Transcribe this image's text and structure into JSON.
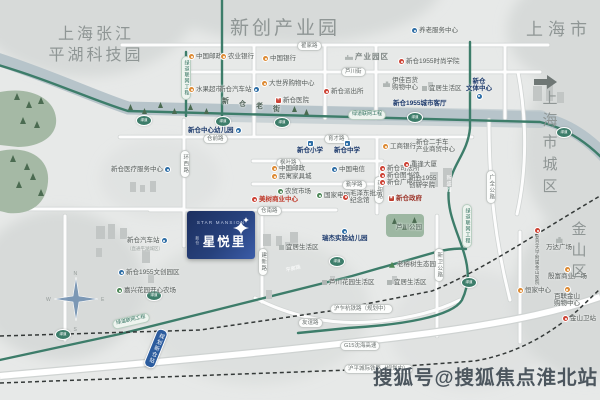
{
  "watermark": "搜狐号@搜狐焦点淮北站",
  "project": {
    "name_en": "STAR MANSION",
    "name_cn": "星悦里",
    "district": "新仓"
  },
  "area_labels": [
    {
      "id": "al0",
      "text": "上海张江\n平湖科技园"
    },
    {
      "id": "al1",
      "text": "新创产业园"
    },
    {
      "id": "al2",
      "text": "上海市"
    },
    {
      "id": "al3",
      "text": "上海市城区"
    },
    {
      "id": "al4",
      "text": "金山区"
    }
  ],
  "old_street": {
    "text": "新仓老街",
    "x": 222,
    "y": 98
  },
  "badge_text": "绿道",
  "station": {
    "t": "规划新仓站",
    "x": 150,
    "y": 328
  },
  "road_labels": [
    {
      "t": "翟家路",
      "x": 297,
      "y": 41
    },
    {
      "t": "芦川街",
      "x": 341,
      "y": 67
    },
    {
      "t": "仓前路",
      "x": 203,
      "y": 134
    },
    {
      "t": "育才路",
      "x": 324,
      "y": 134
    },
    {
      "t": "枫叶路",
      "x": 276,
      "y": 158
    },
    {
      "t": "勤学路",
      "x": 342,
      "y": 180
    },
    {
      "t": "仓南路",
      "x": 257,
      "y": 206
    },
    {
      "t": "友谊路",
      "x": 298,
      "y": 318
    },
    {
      "t": "沪乍杭铁路（规划中）",
      "x": 330,
      "y": 304
    },
    {
      "t": "G15沈海高速",
      "x": 340,
      "y": 341
    },
    {
      "t": "沪平城际铁路（规划中）",
      "x": 344,
      "y": 364
    },
    {
      "t": "环西路",
      "x": 180,
      "y": 150,
      "vertical": true
    },
    {
      "t": "新阳路",
      "x": 374,
      "y": 176,
      "vertical": true
    },
    {
      "t": "建新路",
      "x": 258,
      "y": 248,
      "vertical": true
    },
    {
      "t": "新卫公路",
      "x": 434,
      "y": 248,
      "vertical": true
    },
    {
      "t": "广全公路",
      "x": 486,
      "y": 170,
      "vertical": true
    },
    {
      "t": "新盛路",
      "x": 444,
      "y": 172,
      "vertical": true,
      "style": "onGreen"
    },
    {
      "t": "平廊路",
      "x": 283,
      "y": 266,
      "rotate": -14,
      "style": "onGreen2"
    },
    {
      "t": "绿道联网工程",
      "x": 348,
      "y": 110,
      "style": "green"
    },
    {
      "t": "绿道联网工程",
      "x": 181,
      "y": 56,
      "vertical": true,
      "style": "green"
    },
    {
      "t": "绿道联网工程",
      "x": 462,
      "y": 204,
      "vertical": true,
      "style": "green"
    },
    {
      "t": "绿道联网工程",
      "x": 112,
      "y": 316,
      "rotate": -13,
      "style": "green"
    }
  ],
  "badges": [
    {
      "x": 136,
      "y": 115
    },
    {
      "x": 215,
      "y": 116
    },
    {
      "x": 274,
      "y": 117
    },
    {
      "x": 407,
      "y": 112
    },
    {
      "x": 556,
      "y": 127
    },
    {
      "x": 55,
      "y": 329
    },
    {
      "x": 146,
      "y": 290
    },
    {
      "x": 329,
      "y": 256
    },
    {
      "x": 461,
      "y": 277
    }
  ],
  "pois": [
    {
      "t": "中国邮政",
      "type": "post",
      "x": 189,
      "y": 53
    },
    {
      "t": "农业银行",
      "type": "bank",
      "x": 221,
      "y": 53
    },
    {
      "t": "中国银行",
      "type": "bank",
      "x": 263,
      "y": 55
    },
    {
      "t": "产业园区",
      "type": "factory",
      "x": 345,
      "y": 53,
      "cls": "bigarea"
    },
    {
      "t": "养老服务中心",
      "type": "blue",
      "x": 412,
      "y": 27
    },
    {
      "t": "新仓1955时尚学院",
      "type": "red",
      "x": 399,
      "y": 58
    },
    {
      "t": "水果超市",
      "type": "orange",
      "x": 189,
      "y": 86
    },
    {
      "t": "新仓汽车站",
      "type": "bus",
      "iconSide": "right",
      "x": 219,
      "y": 86
    },
    {
      "t": "大世界购物中心",
      "type": "orange",
      "x": 262,
      "y": 80
    },
    {
      "t": "新仓医院",
      "type": "cross",
      "x": 276,
      "y": 97
    },
    {
      "t": "新仓派出所",
      "type": "red",
      "x": 324,
      "y": 88
    },
    {
      "t": "伊佳百货\n购物中心",
      "type": "buildings",
      "x": 383,
      "y": 77
    },
    {
      "t": "宜居生活区",
      "type": "building",
      "x": 422,
      "y": 85
    },
    {
      "t": "新仓1955城市客厅",
      "type": "none",
      "x": 393,
      "y": 100,
      "cls": "navy"
    },
    {
      "t": "新仓\n文体中心",
      "type": "blue",
      "iconSide": "bottom",
      "x": 466,
      "y": 78,
      "cls": "navy"
    },
    {
      "t": "新仓中心幼儿园",
      "type": "blue",
      "iconSide": "right",
      "x": 188,
      "y": 127,
      "cls": "navy"
    },
    {
      "t": "新仓医疗服务中心",
      "type": "blue",
      "iconSide": "right",
      "x": 111,
      "y": 166
    },
    {
      "t": "新仓小学",
      "type": "school",
      "iconSide": "top",
      "x": 297,
      "y": 141,
      "cls": "navy"
    },
    {
      "t": "新仓中学",
      "type": "school",
      "iconSide": "top",
      "x": 334,
      "y": 141,
      "cls": "navy"
    },
    {
      "t": "工商银行",
      "type": "bank",
      "x": 383,
      "y": 143
    },
    {
      "t": "新仓二手车\n产业商贸中心",
      "type": "none",
      "x": 416,
      "y": 139
    },
    {
      "t": "中国邮政",
      "type": "post",
      "x": 272,
      "y": 165
    },
    {
      "t": "民寓家具城",
      "type": "orange",
      "x": 272,
      "y": 173
    },
    {
      "t": "中国电信",
      "type": "blue",
      "x": 332,
      "y": 166
    },
    {
      "t": "新仓司法所",
      "type": "red",
      "x": 380,
      "y": 165
    },
    {
      "t": "新仓图书馆",
      "type": "red",
      "x": 380,
      "y": 172
    },
    {
      "t": "新仓广电中心",
      "type": "red",
      "x": 380,
      "y": 179
    },
    {
      "t": "重逢大厦",
      "type": "red",
      "x": 404,
      "y": 161
    },
    {
      "t": "新仓1955\n创新学院",
      "type": "none",
      "x": 409,
      "y": 175
    },
    {
      "t": "新仓政府",
      "type": "gov",
      "x": 389,
      "y": 195,
      "cls": "govtext"
    },
    {
      "t": "农贸市场",
      "type": "green",
      "x": 278,
      "y": 188
    },
    {
      "t": "国家电网",
      "type": "green",
      "x": 317,
      "y": 192
    },
    {
      "t": "毛泽东批示\n纪念馆",
      "type": "red",
      "x": 343,
      "y": 190
    },
    {
      "t": "美树商业中心",
      "type": "red",
      "x": 252,
      "y": 196,
      "cls": "redbold"
    },
    {
      "t": "芦川公园",
      "type": "none",
      "x": 396,
      "y": 224,
      "cls": "parklabel"
    },
    {
      "t": "宜居生活区",
      "type": "building",
      "x": 279,
      "y": 244
    },
    {
      "t": "瑞杰实验幼儿园",
      "type": "blue",
      "iconSide": "top",
      "x": 322,
      "y": 229,
      "cls": "navy"
    },
    {
      "t": "老榕树生态园",
      "type": "tree",
      "x": 389,
      "y": 261
    },
    {
      "t": "芦川花园生活区",
      "type": "building",
      "x": 322,
      "y": 279
    },
    {
      "t": "宜居生活区",
      "type": "building",
      "x": 387,
      "y": 279
    },
    {
      "t": "新仓汽车站",
      "type": "bus",
      "iconSide": "right",
      "x": 127,
      "y": 237,
      "sub": "（直通平湖城区）"
    },
    {
      "t": "新仓1955文创园区",
      "type": "blue",
      "x": 119,
      "y": 269
    },
    {
      "t": "嘉兴花园开心农场",
      "type": "green",
      "x": 117,
      "y": 287
    },
    {
      "t": "万达广场",
      "type": "buildings",
      "iconSide": "top",
      "x": 546,
      "y": 237
    },
    {
      "t": "复旦大学附属金山医院",
      "type": "red",
      "x": 535,
      "y": 228,
      "vertical": true
    },
    {
      "t": "殷富商业广场",
      "type": "orange",
      "iconSide": "top",
      "x": 548,
      "y": 267
    },
    {
      "t": "恒家中心",
      "type": "orange",
      "x": 518,
      "y": 287
    },
    {
      "t": "百联金山\n购物中心",
      "type": "orange",
      "iconSide": "top",
      "x": 554,
      "y": 287
    },
    {
      "t": "金山卫站",
      "type": "rail",
      "x": 563,
      "y": 315
    }
  ]
}
